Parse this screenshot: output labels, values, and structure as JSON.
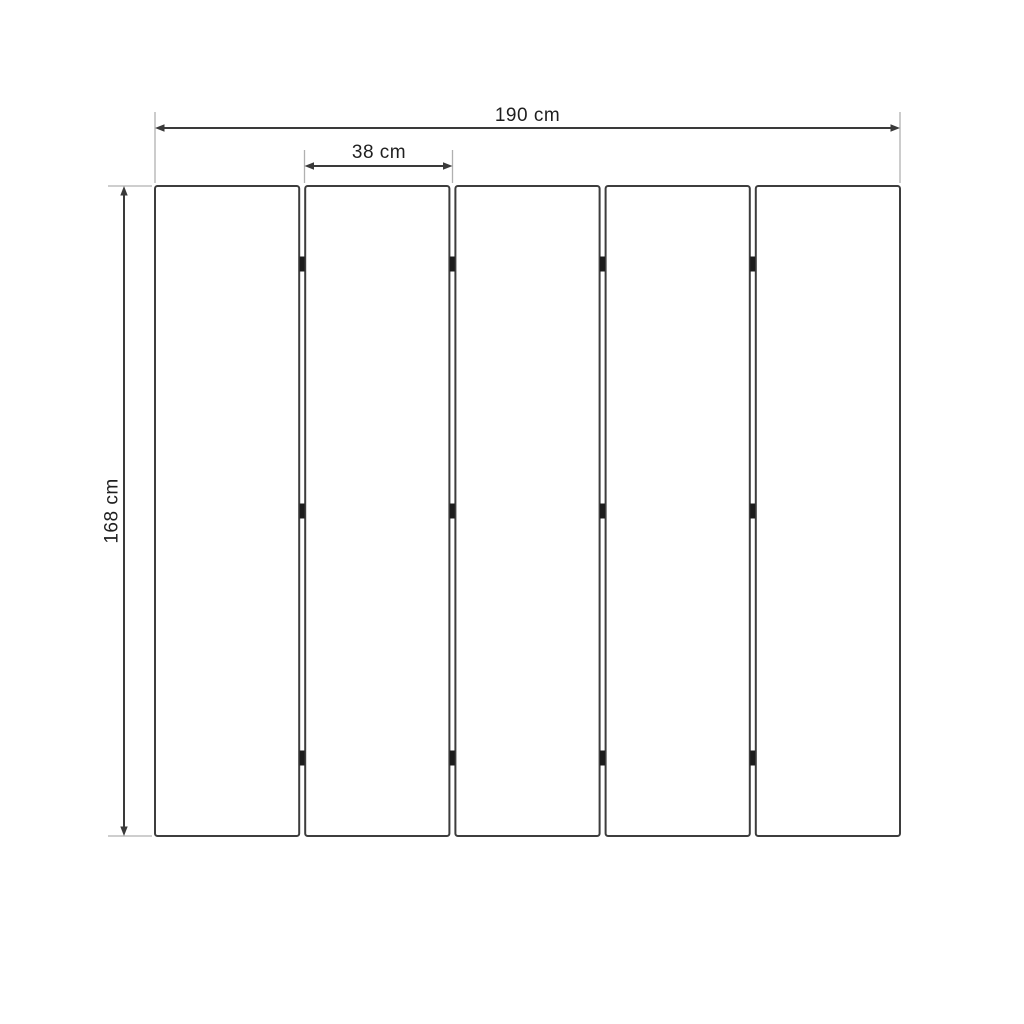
{
  "diagram": {
    "panel_count": 5,
    "hinge_rows": 3,
    "unit": "cm",
    "dimensions": {
      "total_width": {
        "value": 190,
        "label": "190 cm"
      },
      "panel_width": {
        "value": 38,
        "label": "38 cm"
      },
      "height": {
        "value": 168,
        "label": "168 cm"
      }
    },
    "colors": {
      "background": "#ffffff",
      "panel_border": "#3d3d3d",
      "panel_fill": "#ffffff",
      "dimension_line": "#3a3a3a",
      "extension_line": "#b0b0b0",
      "hinge": "#1c1c1c",
      "text": "#1f1f1f"
    }
  }
}
